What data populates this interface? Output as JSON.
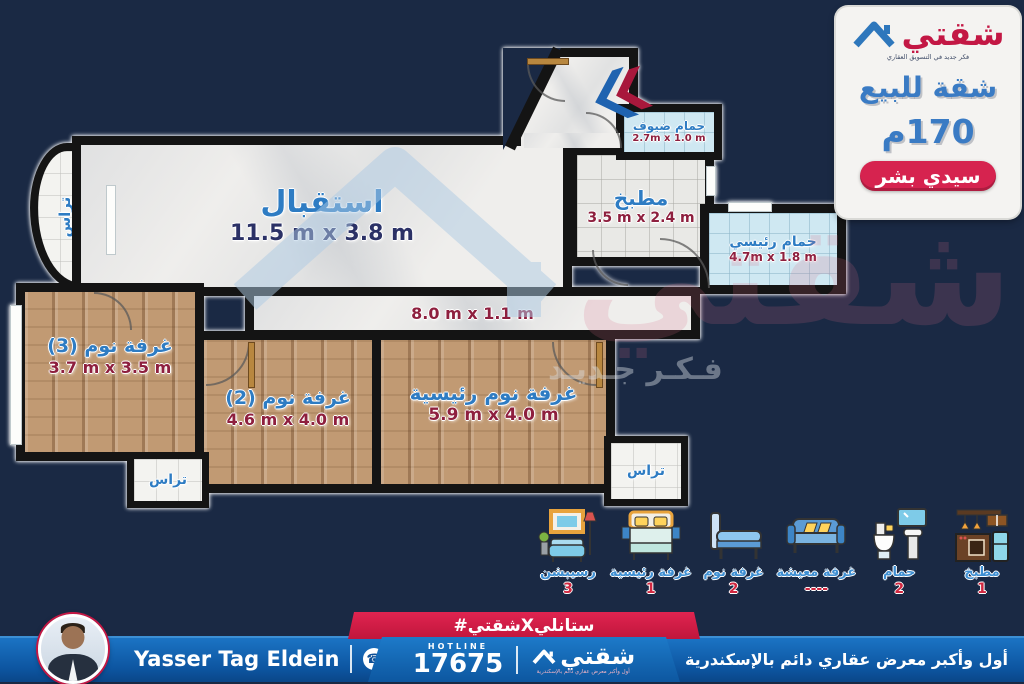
{
  "colors": {
    "background": "#1a2944",
    "accent_blue": "#2e7cc3",
    "accent_red": "#c31744",
    "dims_red": "#8e1f3e",
    "dims_navy": "#2b3166",
    "footer_blue": "#0d55a0",
    "ribbon_red": "#d01d45"
  },
  "info_panel": {
    "logo_text": "شقتي",
    "logo_tagline": "فكر جديد في التسويق العقاري",
    "title": "شقة للبيع",
    "area": "170م",
    "location": "سيدي بشر"
  },
  "floorplan": {
    "watermark_brand": "شقتي",
    "watermark_tagline": "فـكـر جـديـد",
    "rooms": {
      "reception": {
        "label": "استقبال",
        "dims": "11.5 m x 3.8 m"
      },
      "guest_bath": {
        "label": "حمام ضيوف",
        "dims": "2.7m x 1.0 m"
      },
      "kitchen": {
        "label": "مطبخ",
        "dims": "3.5 m x 2.4 m"
      },
      "master_bath": {
        "label": "حمام رئيسي",
        "dims": "4.7m x 1.8 m"
      },
      "terrace_left": {
        "label": "تراس",
        "dims": "3.8 m x 1.8 m"
      },
      "corridor": {
        "dims": "8.0 m x 1.1 m"
      },
      "bedroom3": {
        "label": "غرفة نوم (3)",
        "dims": "3.7 m x 3.5 m"
      },
      "bedroom2": {
        "label": "غرفة نوم (2)",
        "dims": "4.6 m x 4.0 m"
      },
      "master_bedroom": {
        "label": "غرفة نوم رئيسية",
        "dims": "5.9 m x 4.0 m"
      },
      "terrace_bottom_left": {
        "label": "تراس"
      },
      "terrace_bottom_right": {
        "label": "تراس"
      }
    }
  },
  "legend": {
    "items": [
      {
        "icon": "reception-furniture-icon",
        "label": "رسيبشن",
        "count": "3"
      },
      {
        "icon": "master-bed-icon",
        "label": "غرفة رئيسية",
        "count": "1"
      },
      {
        "icon": "single-bed-icon",
        "label": "غرفة نوم",
        "count": "2"
      },
      {
        "icon": "sofa-icon",
        "label": "غرفة معيشة",
        "count": "----"
      },
      {
        "icon": "bathroom-icon",
        "label": "حمام",
        "count": "2"
      },
      {
        "icon": "kitchen-icon",
        "label": "مطبخ",
        "count": "1"
      }
    ]
  },
  "footer": {
    "agent_name": "Yasser Tag Eldein",
    "phone": "011 224 115 99",
    "hashtag": "#شقتيXستانلي",
    "hotline_label": "HOTLINE",
    "hotline_number": "17675",
    "brand": "شقتي",
    "brand_tagline": "أول وأكبر معرض عقاري دائم بالإسكندرية",
    "right_text": "أول وأكبر معرض عقاري دائم بالإسكندرية"
  }
}
